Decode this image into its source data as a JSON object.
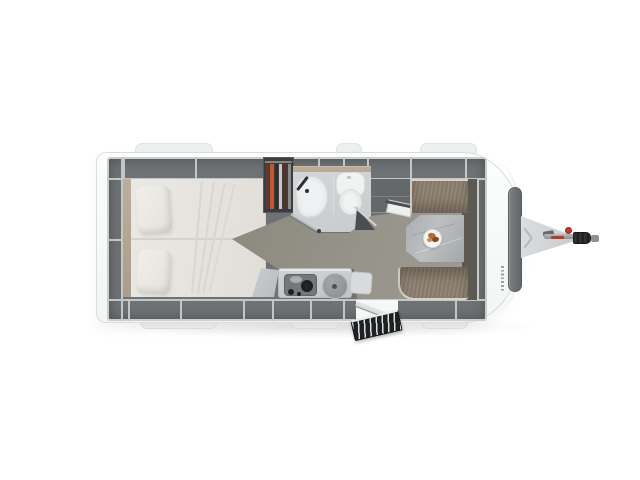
{
  "page": {
    "background": "#ffffff",
    "description": "Top-down rendering of a single-axle caravan floor plan, hitch pointing right"
  },
  "floorplan": {
    "areas": {
      "bedroom": "Rear double bed with two pillows and surrounding overhead lockers",
      "wardrobe": "Wardrobe with hanging clothes",
      "bathroom": "Washroom with shower tray and toilet behind angled doors",
      "kitchen": "Kitchenette with hob, round sink and worktop extension flap",
      "dinette": "Front dinette with pedestal table, serving plate and upholstered benches",
      "entry": "Entry doorway with folding entry step",
      "drawbar": "A-frame drawbar with jockey-wheel handle and hitch coupling",
      "front_window": "Front panoramic window seen from above"
    },
    "colors": {
      "body_white": "#fafbfb",
      "locker_gray": "#6e7275",
      "bedding_cream": "#e8e5e0",
      "wood_trim": "#b7a995",
      "bathroom_gray": "#ced1d3",
      "floor_olive": "#96948a",
      "upholstery_taupe": "#8b7e6f",
      "table_marble": "#aeb3b6",
      "accent_red": "#c13b2d",
      "step_black": "#1e2022"
    }
  }
}
